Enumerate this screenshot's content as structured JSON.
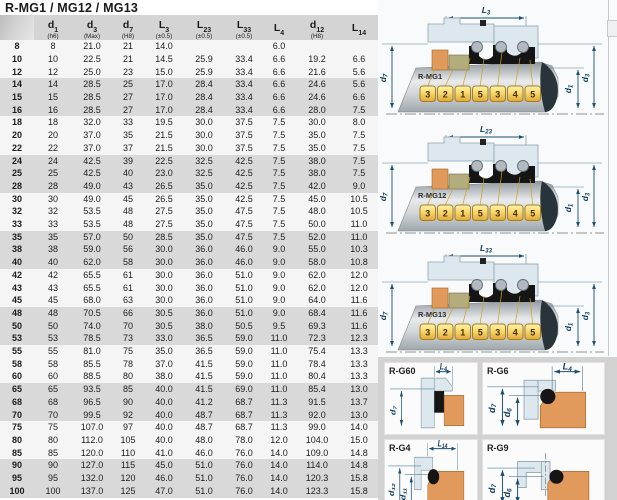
{
  "title": "R-MG1 / MG12 / MG13",
  "table": {
    "columns": [
      {
        "main": "d",
        "sub": "1",
        "note": "(h6)"
      },
      {
        "main": "d",
        "sub": "3",
        "note": "(Max)"
      },
      {
        "main": "d",
        "sub": "7",
        "note": "(H8)"
      },
      {
        "main": "L",
        "sub": "3",
        "note": "(±0.5)"
      },
      {
        "main": "L",
        "sub": "23",
        "note": "(±0.5)"
      },
      {
        "main": "L",
        "sub": "33",
        "note": "(±0.5)"
      },
      {
        "main": "L",
        "sub": "4",
        "note": ""
      },
      {
        "main": "d",
        "sub": "12",
        "note": "(H8)"
      },
      {
        "main": "L",
        "sub": "14",
        "note": ""
      }
    ],
    "rows": [
      [
        "8",
        "8",
        "21.0",
        "21",
        "14.0",
        "",
        "",
        "6.0",
        "",
        ""
      ],
      [
        "10",
        "10",
        "22.5",
        "21",
        "14.5",
        "25.9",
        "33.4",
        "6.6",
        "19.2",
        "6.6"
      ],
      [
        "12",
        "12",
        "25.0",
        "23",
        "15.0",
        "25.9",
        "33.4",
        "6.6",
        "21.6",
        "5.6"
      ],
      [
        "14",
        "14",
        "28.5",
        "25",
        "17.0",
        "28.4",
        "33.4",
        "6.6",
        "24.6",
        "5.6"
      ],
      [
        "15",
        "15",
        "28.5",
        "27",
        "17.0",
        "28.4",
        "33.4",
        "6.6",
        "24.6",
        "6.6"
      ],
      [
        "16",
        "16",
        "28.5",
        "27",
        "17.0",
        "28.4",
        "33.4",
        "6.6",
        "28.0",
        "7.5"
      ],
      [
        "18",
        "18",
        "32.0",
        "33",
        "19.5",
        "30.0",
        "37.5",
        "7.5",
        "30.0",
        "8.0"
      ],
      [
        "20",
        "20",
        "37.0",
        "35",
        "21.5",
        "30.0",
        "37.5",
        "7.5",
        "35.0",
        "7.5"
      ],
      [
        "22",
        "22",
        "37.0",
        "37",
        "21.5",
        "30.0",
        "37.5",
        "7.5",
        "35.0",
        "7.5"
      ],
      [
        "24",
        "24",
        "42.5",
        "39",
        "22.5",
        "32.5",
        "42.5",
        "7.5",
        "38.0",
        "7.5"
      ],
      [
        "25",
        "25",
        "42.5",
        "40",
        "23.0",
        "32.5",
        "42.5",
        "7.5",
        "38.0",
        "7.5"
      ],
      [
        "28",
        "28",
        "49.0",
        "43",
        "26.5",
        "35.0",
        "42.5",
        "7.5",
        "42.0",
        "9.0"
      ],
      [
        "30",
        "30",
        "49.0",
        "45",
        "26.5",
        "35.0",
        "42.5",
        "7.5",
        "45.0",
        "10.5"
      ],
      [
        "32",
        "32",
        "53.5",
        "48",
        "27.5",
        "35.0",
        "47.5",
        "7.5",
        "48.0",
        "10.5"
      ],
      [
        "33",
        "33",
        "53.5",
        "48",
        "27.5",
        "35.0",
        "47.5",
        "7.5",
        "50.0",
        "11.0"
      ],
      [
        "35",
        "35",
        "57.0",
        "50",
        "28.5",
        "35.0",
        "47.5",
        "7.5",
        "52.0",
        "11.0"
      ],
      [
        "38",
        "38",
        "59.0",
        "56",
        "30.0",
        "36.0",
        "46.0",
        "9.0",
        "55.0",
        "10.3"
      ],
      [
        "40",
        "40",
        "62.0",
        "58",
        "30.0",
        "36.0",
        "46.0",
        "9.0",
        "58.0",
        "10.8"
      ],
      [
        "42",
        "42",
        "65.5",
        "61",
        "30.0",
        "36.0",
        "51.0",
        "9.0",
        "62.0",
        "12.0"
      ],
      [
        "43",
        "43",
        "65.5",
        "61",
        "30.0",
        "36.0",
        "51.0",
        "9.0",
        "62.0",
        "12.0"
      ],
      [
        "45",
        "45",
        "68.0",
        "63",
        "30.0",
        "36.0",
        "51.0",
        "9.0",
        "64.0",
        "11.6"
      ],
      [
        "48",
        "48",
        "70.5",
        "66",
        "30.5",
        "36.0",
        "51.0",
        "9.0",
        "68.4",
        "11.6"
      ],
      [
        "50",
        "50",
        "74.0",
        "70",
        "30.5",
        "38.0",
        "50.5",
        "9.5",
        "69.3",
        "11.6"
      ],
      [
        "53",
        "53",
        "78.5",
        "73",
        "33.0",
        "36.5",
        "59.0",
        "11.0",
        "72.3",
        "12.3"
      ],
      [
        "55",
        "55",
        "81.0",
        "75",
        "35.0",
        "36.5",
        "59.0",
        "11.0",
        "75.4",
        "13.3"
      ],
      [
        "58",
        "58",
        "85.5",
        "78",
        "37.0",
        "41.5",
        "59.0",
        "11.0",
        "78.4",
        "13.3"
      ],
      [
        "60",
        "60",
        "88.5",
        "80",
        "38.0",
        "41.5",
        "59.0",
        "11.0",
        "80.4",
        "13.3"
      ],
      [
        "65",
        "65",
        "93.5",
        "85",
        "40.0",
        "41.5",
        "69.0",
        "11.0",
        "85.4",
        "13.0"
      ],
      [
        "68",
        "68",
        "96.5",
        "90",
        "40.0",
        "41.2",
        "68.7",
        "11.3",
        "91.5",
        "13.7"
      ],
      [
        "70",
        "70",
        "99.5",
        "92",
        "40.0",
        "48.7",
        "68.7",
        "11.3",
        "92.0",
        "13.0"
      ],
      [
        "75",
        "75",
        "107.0",
        "97",
        "40.0",
        "48.7",
        "68.7",
        "11.3",
        "99.0",
        "14.0"
      ],
      [
        "80",
        "80",
        "112.0",
        "105",
        "40.0",
        "48.0",
        "78.0",
        "12.0",
        "104.0",
        "15.0"
      ],
      [
        "85",
        "85",
        "120.0",
        "110",
        "41.0",
        "46.0",
        "76.0",
        "14.0",
        "109.0",
        "14.8"
      ],
      [
        "90",
        "90",
        "127.0",
        "115",
        "45.0",
        "51.0",
        "76.0",
        "14.0",
        "114.0",
        "14.8"
      ],
      [
        "95",
        "95",
        "132.0",
        "120",
        "46.0",
        "51.0",
        "76.0",
        "14.0",
        "120.3",
        "15.8"
      ],
      [
        "100",
        "100",
        "137.0",
        "125",
        "47.0",
        "51.0",
        "76.0",
        "14.0",
        "123.3",
        "15.8"
      ]
    ]
  },
  "diagrams": [
    {
      "label": "R-MG1",
      "dim_top_main": "L",
      "dim_top_sub": "3",
      "d_left_main": "d",
      "d_left_sub": "7",
      "d_right1_main": "d",
      "d_right1_sub": "1",
      "d_right2_main": "d",
      "d_right2_sub": "3",
      "plates": [
        "3",
        "2",
        "1",
        "5",
        "3",
        "4",
        "5"
      ]
    },
    {
      "label": "R-MG12",
      "dim_top_main": "L",
      "dim_top_sub": "23",
      "d_left_main": "d",
      "d_left_sub": "7",
      "d_right1_main": "d",
      "d_right1_sub": "1",
      "d_right2_main": "d",
      "d_right2_sub": "3",
      "plates": [
        "3",
        "2",
        "1",
        "5",
        "3",
        "4",
        "5"
      ]
    },
    {
      "label": "R-MG13",
      "dim_top_main": "L",
      "dim_top_sub": "33",
      "d_left_main": "d",
      "d_left_sub": "7",
      "d_right1_main": "d",
      "d_right1_sub": "1",
      "d_right2_main": "d",
      "d_right2_sub": "3",
      "plates": [
        "3",
        "2",
        "1",
        "5",
        "3",
        "4",
        "5"
      ]
    }
  ],
  "cards": [
    {
      "label": "R-G60",
      "dim_top_main": "L",
      "dim_top_sub": "4",
      "d1_main": "d",
      "d1_sub": "7"
    },
    {
      "label": "R-G6",
      "dim_top_main": "L",
      "dim_top_sub": "4",
      "d1_main": "d",
      "d1_sub": "7",
      "d2_main": "d",
      "d2_sub": "6"
    },
    {
      "label": "R-G4",
      "dim_top_main": "L",
      "dim_top_sub": "14",
      "d1_main": "d",
      "d1_sub": "12",
      "d2_main": "d",
      "d2_sub": "11"
    },
    {
      "label": "R-G9",
      "d1_main": "d",
      "d1_sub": "7",
      "d2_main": "d",
      "d2_sub": "6"
    }
  ],
  "colors": {
    "dim_accent": "#1b4f72",
    "plate_gold": "#e8b93f",
    "elastomer_orange": "#e2995c",
    "stripe_gray": "#d9d9d9"
  }
}
